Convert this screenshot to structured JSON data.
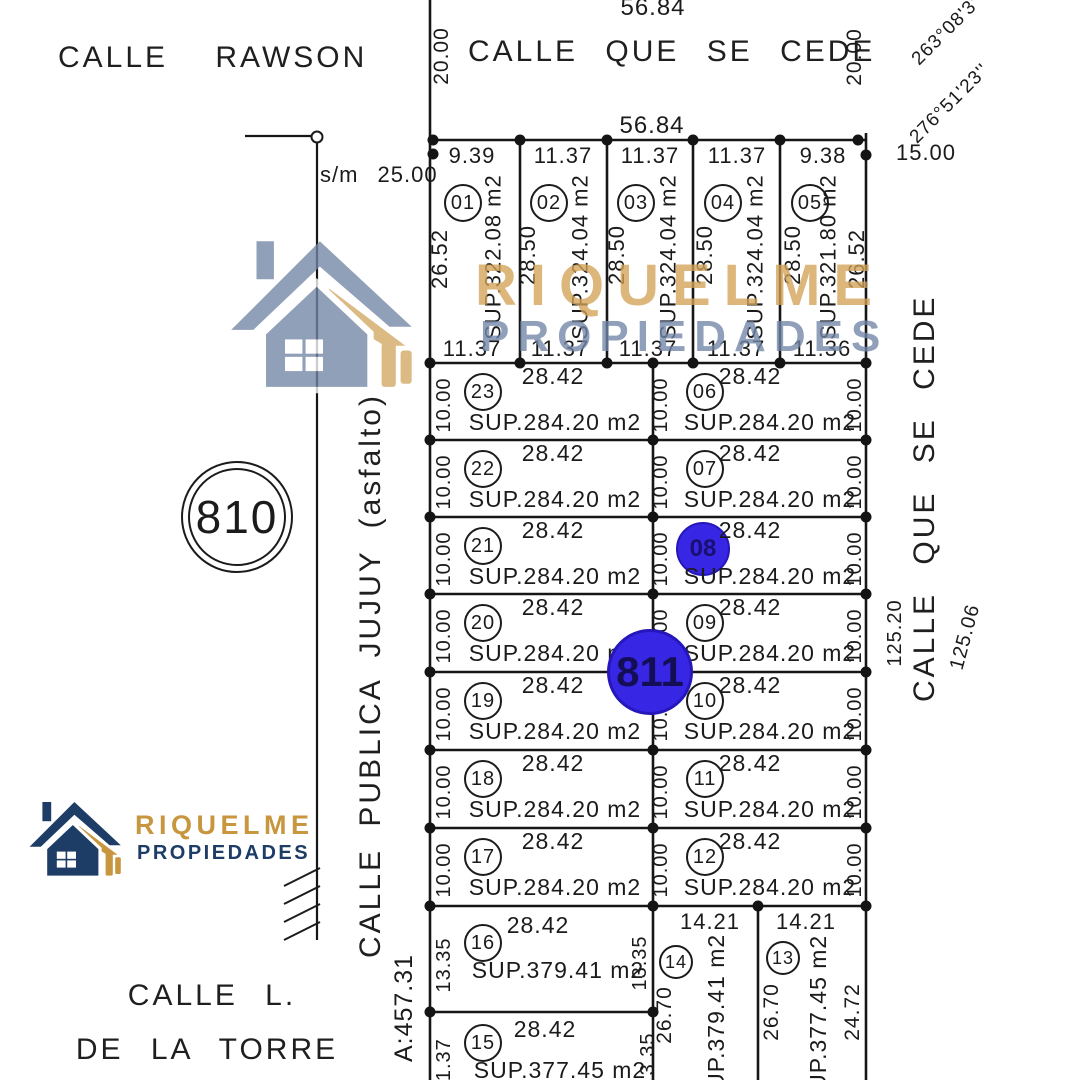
{
  "brand": {
    "line1": "RIQUELME",
    "line2": "PROPIEDADES",
    "gold": "#C8963E",
    "navy": "#1D3C66",
    "slate": "#7286A8",
    "wm_gold": "#D3A255"
  },
  "colors": {
    "marker_blue": "#3726E4",
    "ink": "#1B1B1B"
  },
  "streets": {
    "rawson": "CALLE RAWSON",
    "cede_top": "CALLE QUE SE CEDE",
    "cede_right": "CALLE QUE SE CEDE",
    "jujuy": "CALLE PUBLICA JUJUY (asfalto)",
    "torre_line1": "CALLE L.",
    "torre_line2": "DE LA TORRE"
  },
  "markers": {
    "block_left": "810",
    "point_center": "811",
    "point_lot08": "08"
  },
  "top_street": {
    "outer_len": "56.84",
    "inner_len": "56.84",
    "w_left": "20.00",
    "w_right": "20.00",
    "bearing_1": "263°08'3''",
    "bearing_2": "276°51'23''",
    "east_side": "15.00",
    "sm_note": "s/m 25.00"
  },
  "top_lots": [
    {
      "id": "01",
      "w": "9.39",
      "sup": "SUP.322.08 m2",
      "bottom": "11.37"
    },
    {
      "id": "02",
      "w": "11.37",
      "sup": "SUP.324.04 m2",
      "bottom": "11.37",
      "depth": "28.50"
    },
    {
      "id": "03",
      "w": "11.37",
      "sup": "SUP.324.04 m2",
      "bottom": "11.37",
      "depth": "28.50"
    },
    {
      "id": "04",
      "w": "11.37",
      "sup": "SUP.324.04 m2",
      "bottom": "11.37",
      "depth": "28.50"
    },
    {
      "id": "05",
      "w": "9.38",
      "sup": "SUP.321.80 m2",
      "bottom": "11.36",
      "depth": "28.50"
    }
  ],
  "top_sides": {
    "left": "26.52",
    "right": "26.52"
  },
  "mid_rows": [
    {
      "left": {
        "id": "23",
        "top": "28.42",
        "side": "10.00",
        "sup": "SUP.284.20 m2"
      },
      "right": {
        "id": "06",
        "top": "28.42",
        "side_l": "10.00",
        "side_r": "10.00",
        "sup": "SUP.284.20 m2"
      }
    },
    {
      "left": {
        "id": "22",
        "top": "28.42",
        "side": "10.00",
        "sup": "SUP.284.20 m2"
      },
      "right": {
        "id": "07",
        "top": "28.42",
        "side_l": "10.00",
        "side_r": "10.00",
        "sup": "SUP.284.20 m2"
      }
    },
    {
      "left": {
        "id": "21",
        "top": "28.42",
        "side": "10.00",
        "sup": "SUP.284.20 m2"
      },
      "right": {
        "id": "08",
        "top": "28.42",
        "side_l": "10.00",
        "side_r": "10.00",
        "sup": "SUP.284.20 m2"
      }
    },
    {
      "left": {
        "id": "20",
        "top": "28.42",
        "side": "10.00",
        "sup": "SUP.284.20 m2"
      },
      "right": {
        "id": "09",
        "top": "28.42",
        "side_l": "10.00",
        "side_r": "10.00",
        "sup": "SUP.284.20 m2"
      }
    },
    {
      "left": {
        "id": "19",
        "top": "28.42",
        "side": "10.00",
        "sup": "SUP.284.20 m2"
      },
      "right": {
        "id": "10",
        "top": "28.42",
        "side_l": "10.00",
        "side_r": "10.00",
        "sup": "SUP.284.20 m2"
      }
    },
    {
      "left": {
        "id": "18",
        "top": "28.42",
        "side": "10.00",
        "sup": "SUP.284.20 m2"
      },
      "right": {
        "id": "11",
        "top": "28.42",
        "side_l": "10.00",
        "side_r": "10.00",
        "sup": "SUP.284.20 m2"
      }
    },
    {
      "left": {
        "id": "17",
        "top": "28.42",
        "side": "10.00",
        "sup": "SUP.284.20 m2"
      },
      "right": {
        "id": "12",
        "top": "28.42",
        "side_l": "10.00",
        "side_r": "10.00",
        "sup": "SUP.284.20 m2"
      }
    }
  ],
  "bottom_lots": {
    "lot16": {
      "id": "16",
      "top": "28.42",
      "side_l": "13.35",
      "side_r": "13.35",
      "sup": "SUP.379.41 m2"
    },
    "lot15": {
      "id": "15",
      "top": "28.42",
      "side_l": "11.37",
      "side_r": "13.35",
      "sup": "SUP.377.45 m2"
    },
    "lot14": {
      "id": "14",
      "top": "14.21",
      "side": "26.70",
      "sup": "SUP.379.41 m2"
    },
    "lot13": {
      "id": "13",
      "top": "14.21",
      "side": "26.70",
      "side_r": "24.72",
      "sup": "SUP.377.45 m2"
    }
  },
  "east_edge": {
    "d_inner": "125.20",
    "d_outer": "125.06"
  },
  "south_edge": {
    "vert": "A:457.31"
  }
}
